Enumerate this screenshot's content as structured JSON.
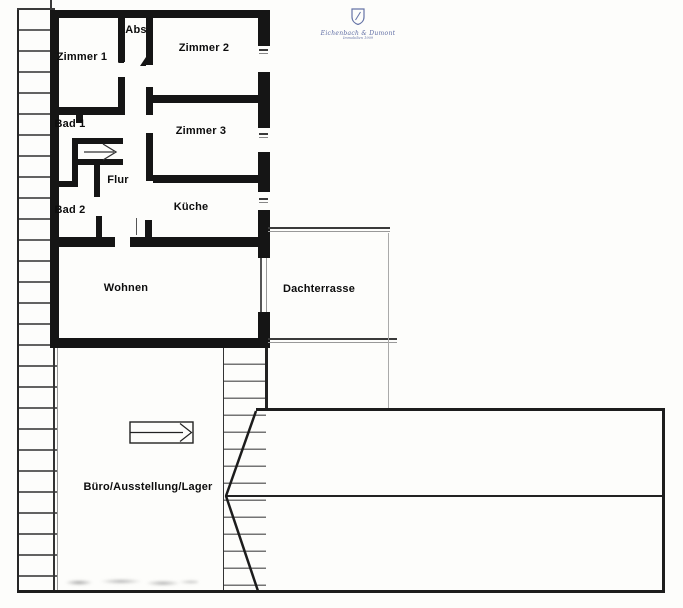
{
  "plan": {
    "title": "Dachgeschoss-Grundriss",
    "rooms": {
      "zimmer1": "Zimmer 1",
      "zimmer2": "Zimmer 2",
      "zimmer3": "Zimmer 3",
      "abs": "Abs",
      "bad1": "Bad 1",
      "bad2": "Bad 2",
      "flur": "Flur",
      "kueche": "Küche",
      "wohnen": "Wohnen",
      "dachterrasse": "Dachterrasse",
      "buero": "Büro/Ausstellung/Lager"
    },
    "logo": {
      "name": "Eichenbach & Dumont",
      "tagline": "Immobilien 1909",
      "color": "#5e6ca3"
    },
    "colors": {
      "wall": "#151515",
      "thin_line": "#3a3a3a",
      "hatch": "#3c3c3c",
      "background": "#fdfdfb"
    }
  }
}
